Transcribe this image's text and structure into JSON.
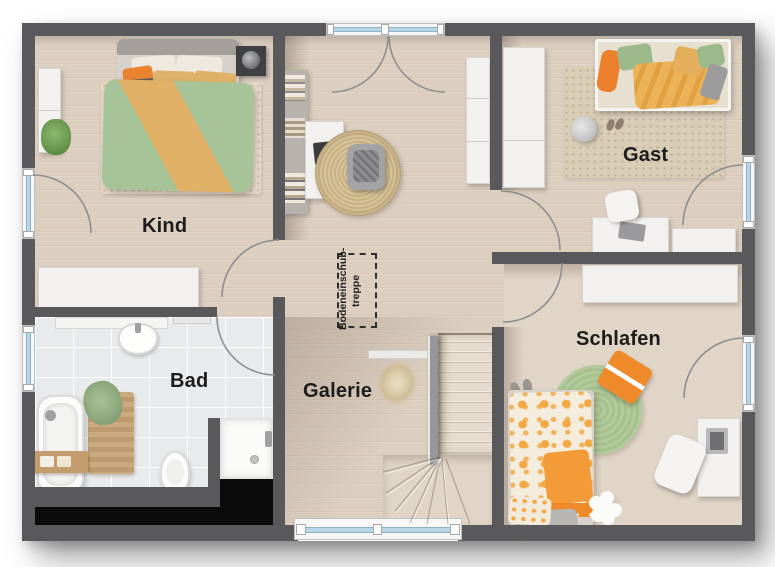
{
  "rooms": {
    "kind": {
      "label": "Kind"
    },
    "gast": {
      "label": "Gast"
    },
    "bad": {
      "label": "Bad"
    },
    "galerie": {
      "label": "Galerie"
    },
    "schlafen": {
      "label": "Schlafen"
    }
  },
  "annotations": {
    "attic_hatch": {
      "line1": "Bodeneinschub-",
      "line2": "treppe"
    }
  },
  "palette": {
    "wall": "#59595b",
    "floor_wood": "#ddcfc0",
    "floor_tile": "#e8eaec",
    "window_glass": "#b9d6e6",
    "door_arc": "#8e8e8e",
    "void_black": "#0b0b0b",
    "label_text": "#1c1c1c",
    "duvet_green": "#a6c497",
    "accent_orange": "#e8832f",
    "accent_tan": "#dfb269",
    "rug_green": "#b0c898",
    "rug_jute": "#d3bd92"
  }
}
